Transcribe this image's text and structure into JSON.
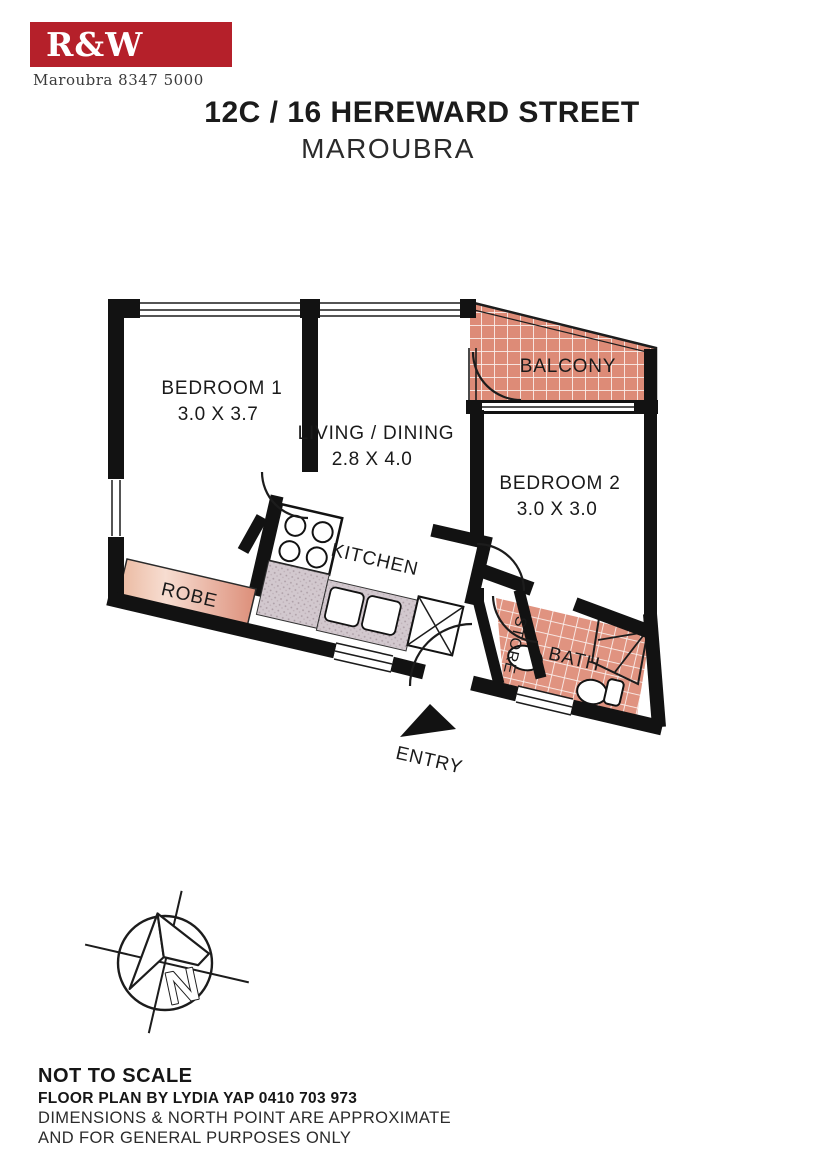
{
  "header": {
    "logo_text": "R&W",
    "logo_bg": "#b5202a",
    "phone_line": "Maroubra  8347 5000",
    "title_line1": "12C / 16 HEREWARD STREET",
    "title_line2": "MAROUBRA"
  },
  "floorplan": {
    "rooms": [
      {
        "id": "bedroom1",
        "label": "BEDROOM 1",
        "dims": "3.0 X 3.7"
      },
      {
        "id": "living",
        "label": "LIVING / DINING",
        "dims": "2.8  X 4.0"
      },
      {
        "id": "bedroom2",
        "label": "BEDROOM 2",
        "dims": "3.0 X 3.0"
      },
      {
        "id": "balcony",
        "label": "BALCONY"
      },
      {
        "id": "kitchen",
        "label": "KITCHEN"
      },
      {
        "id": "robe",
        "label": "ROBE"
      },
      {
        "id": "bath",
        "label": "BATH"
      },
      {
        "id": "store",
        "label": "STORE"
      }
    ],
    "entry_label": "ENTRY",
    "compass_letter": "N",
    "colors": {
      "wall": "#121212",
      "tile": "#dd8b77",
      "grout": "#ffffff",
      "counter_stipple": "#d2c8ce",
      "robe_light": "#f7ddd1",
      "robe_dark": "#dc8e79"
    }
  },
  "footer": {
    "line1": "NOT TO SCALE",
    "line2": "FLOOR PLAN BY LYDIA YAP 0410 703 973",
    "line3": "DIMENSIONS & NORTH POINT ARE APPROXIMATE",
    "line4": "AND FOR GENERAL PURPOSES ONLY"
  }
}
